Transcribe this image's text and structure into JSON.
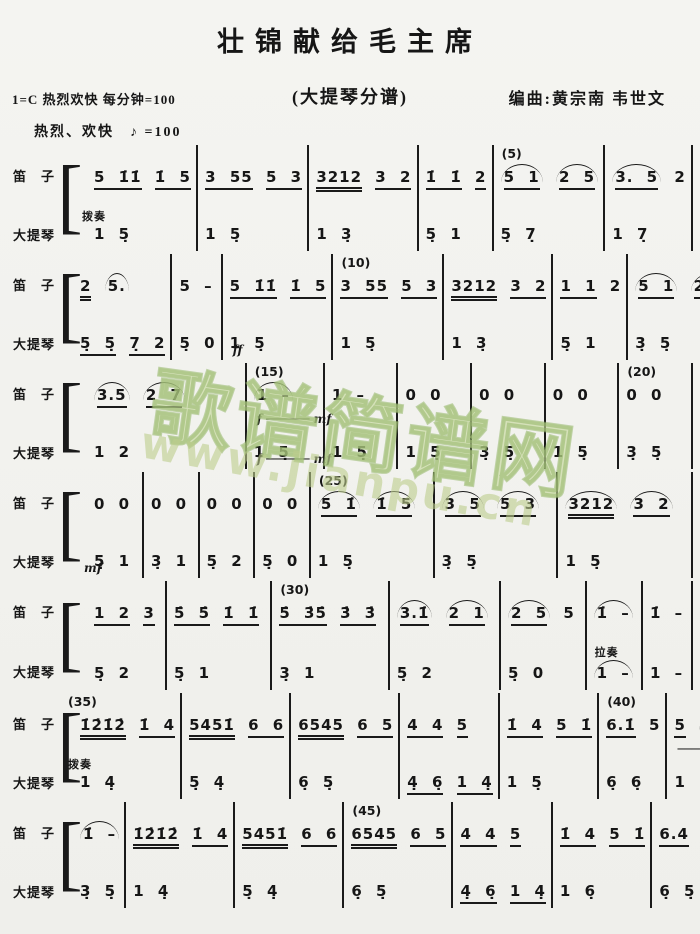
{
  "header": {
    "title": "壮锦献给毛主席",
    "key_line": "1=C  热烈欢快 每分钟=100",
    "part_label": "(大提琴分谱)",
    "composer": "编曲:黄宗南  韦世文",
    "tempo": "热烈、欢快　♪ =100"
  },
  "instruments": {
    "flute": "笛　子",
    "cello": "大提琴"
  },
  "watermark": {
    "site_name": "歌谱简谱网",
    "site_url": "www.jianpu.cn"
  },
  "ink_color": "#1a1a1a",
  "watermark_color": "#a8c47c",
  "systems": [
    {
      "flute": [
        {
          "n": "[5 1̇1̇] [1̇ 5]"
        },
        {
          "n": "[3 55] [5 3]"
        },
        {
          "n": "[[3212]] [3 2]"
        },
        {
          "n": "[1̇ 1̇] [2]"
        },
        {
          "n": "«[5 1]» «[2 5]»",
          "marker": "(5)"
        },
        {
          "n": "«[3. 5]» 2"
        }
      ],
      "cello": [
        {
          "n": "1 5̣",
          "above": "拨奏"
        },
        {
          "n": "1 5̣"
        },
        {
          "n": "1 3̣"
        },
        {
          "n": "5̣ 1"
        },
        {
          "n": "5̣ 7̣"
        },
        {
          "n": "1 7̣"
        }
      ]
    },
    {
      "flute": [
        {
          "n": "[[2]] «5.»"
        },
        {
          "n": "5 –"
        },
        {
          "n": "[5 1̇1̇] [1̇ 5]"
        },
        {
          "n": "[3 55] [5 3]",
          "marker": "(10)"
        },
        {
          "n": "[[3212]] [3 2]"
        },
        {
          "n": "[1 1] 2"
        },
        {
          "n": "«[5 1]» «[2 5]»"
        }
      ],
      "cello": [
        {
          "n": "[5̣ 5̣] [7̣ 2]"
        },
        {
          "n": "5̣ 0"
        },
        {
          "n": "1 5̣",
          "below": "ff"
        },
        {
          "n": "1 5̣"
        },
        {
          "n": "1 3̣"
        },
        {
          "n": "5̣ 1"
        },
        {
          "n": "3̣ 5̣"
        }
      ]
    },
    {
      "flute": [
        {
          "n": "«[3.5]» «[2 7]»"
        },
        {
          "n": "«1 –»",
          "marker": "(15)",
          "below": "f ────── mf"
        },
        {
          "n": "1 –"
        },
        {
          "n": "0 0"
        },
        {
          "n": "0 0"
        },
        {
          "n": "0 0"
        },
        {
          "n": "0 0",
          "marker": "(20)"
        }
      ],
      "cello": [
        {
          "n": "1 2"
        },
        {
          "n": "1 5̣",
          "below": "f ────── mf"
        },
        {
          "n": "1 5̣"
        },
        {
          "n": "1 5̣"
        },
        {
          "n": "3̣ 5̣"
        },
        {
          "n": "1 5̣"
        },
        {
          "n": "3̣ 5̣"
        }
      ]
    },
    {
      "flute": [
        {
          "n": "0 0"
        },
        {
          "n": "0 0"
        },
        {
          "n": "0 0"
        },
        {
          "n": "0 0"
        },
        {
          "n": "«[5 1̇]» «[1̇ 5]»",
          "marker": "(25)"
        },
        {
          "n": "«[3 5]» «[5 3]»"
        },
        {
          "n": "«[[3212]]» «[3 2]»"
        }
      ],
      "cello": [
        {
          "n": "5̣ 1",
          "below": "mf"
        },
        {
          "n": "3̣ 1"
        },
        {
          "n": "5̣ 2"
        },
        {
          "n": "5̣ 0"
        },
        {
          "n": "1 5̣"
        },
        {
          "n": "3̣ 5̣"
        },
        {
          "n": "1 5̣"
        }
      ]
    },
    {
      "flute": [
        {
          "n": "[1 2] [3]"
        },
        {
          "n": "[5̇ 5̇] [1̇ 1̇]"
        },
        {
          "n": "[5̇ 3̇5̇] [3̇ 3̇]",
          "marker": "(30)"
        },
        {
          "n": "«[3.1̇]» «[2 1]»"
        },
        {
          "n": "«[2 5]» 5"
        },
        {
          "n": "«1̇ –»"
        },
        {
          "n": "1̇ –"
        }
      ],
      "cello": [
        {
          "n": "5̣ 2"
        },
        {
          "n": "5̣ 1"
        },
        {
          "n": "3̣ 1"
        },
        {
          "n": "5̣ 2"
        },
        {
          "n": "5̣ 0"
        },
        {
          "n": "«1 –»",
          "above": "拉奏"
        },
        {
          "n": "1 –"
        }
      ]
    },
    {
      "flute": [
        {
          "n": "[[1̇2̇1̇2̇]] [1̇ 4]",
          "marker": "(35)"
        },
        {
          "n": "[[5451̇]] [6 6]"
        },
        {
          "n": "[[6545]] [6 5]"
        },
        {
          "n": "[4 4] [5]"
        },
        {
          "n": "[1̇ 4] [5 1̇]"
        },
        {
          "n": "[6.1̇] 5",
          "marker": "(40)"
        },
        {
          "n": "[5] «1̇.    »",
          "below": "──────"
        }
      ],
      "cello": [
        {
          "n": "1 4̣",
          "above": "拨奏"
        },
        {
          "n": "5̣ 4̣"
        },
        {
          "n": "6̣ 5̣"
        },
        {
          "n": "[4̣ 6̣] [1 4̣]"
        },
        {
          "n": "1 5̣"
        },
        {
          "n": "6̣ 6̣"
        },
        {
          "n": "1 5̣"
        }
      ]
    },
    {
      "flute": [
        {
          "n": "«1̇ –»"
        },
        {
          "n": "[[1̇2̇1̇2̇]] [1̇ 4]"
        },
        {
          "n": "[[5451̇]] [6 6]"
        },
        {
          "n": "[[6545]] [6 5]",
          "marker": "(45)"
        },
        {
          "n": "[4 4] [5]"
        },
        {
          "n": "[1̇ 4] [5 1̇]"
        },
        {
          "n": "[6.4] [5 4]"
        }
      ],
      "cello": [
        {
          "n": "3̣ 5̣"
        },
        {
          "n": "1 4̣"
        },
        {
          "n": "5̣ 4̣"
        },
        {
          "n": "6̣ 5̣"
        },
        {
          "n": "[4̣ 6̣] [1 4̣]"
        },
        {
          "n": "1 6̣"
        },
        {
          "n": "6̣ 5̣"
        }
      ]
    }
  ]
}
